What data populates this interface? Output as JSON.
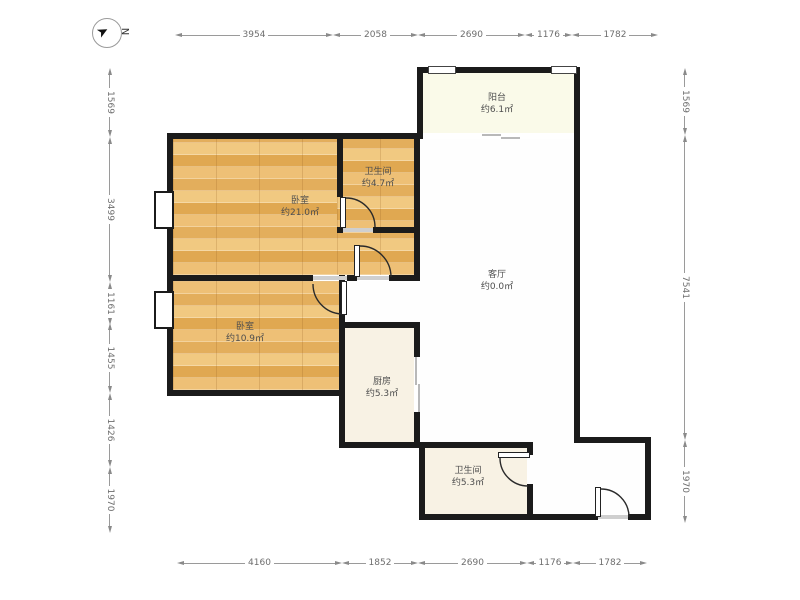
{
  "compass": {
    "label": "N"
  },
  "rooms": [
    {
      "id": "balcony",
      "name": "阳台",
      "area": "约6.1㎡"
    },
    {
      "id": "bathroom-upper",
      "name": "卫生间",
      "area": "约4.7㎡"
    },
    {
      "id": "bedroom-main",
      "name": "卧室",
      "area": "约21.0㎡"
    },
    {
      "id": "living-room",
      "name": "客厅",
      "area": "约0.0㎡"
    },
    {
      "id": "bedroom-second",
      "name": "卧室",
      "area": "约10.9㎡"
    },
    {
      "id": "kitchen",
      "name": "厨房",
      "area": "约5.3㎡"
    },
    {
      "id": "bathroom-lower",
      "name": "卫生间",
      "area": "约5.3㎡"
    }
  ],
  "dimensions_mm": {
    "top": [
      "3954",
      "2058",
      "2690",
      "1176",
      "1782"
    ],
    "bottom": [
      "4160",
      "1852",
      "2690",
      "1176",
      "1782"
    ],
    "left": [
      "1569",
      "3499",
      "1161",
      "1455",
      "1426",
      "1970"
    ],
    "right": [
      "1569",
      "7541",
      "1970"
    ]
  },
  "colors": {
    "wall": "#1b1b1b",
    "wood_floor": "#eab96b",
    "cream_floor": "#f8f2e4",
    "balcony_floor": "#fafae9",
    "dimension_line": "#8a8a8a",
    "label_text": "#4e4e4e"
  }
}
